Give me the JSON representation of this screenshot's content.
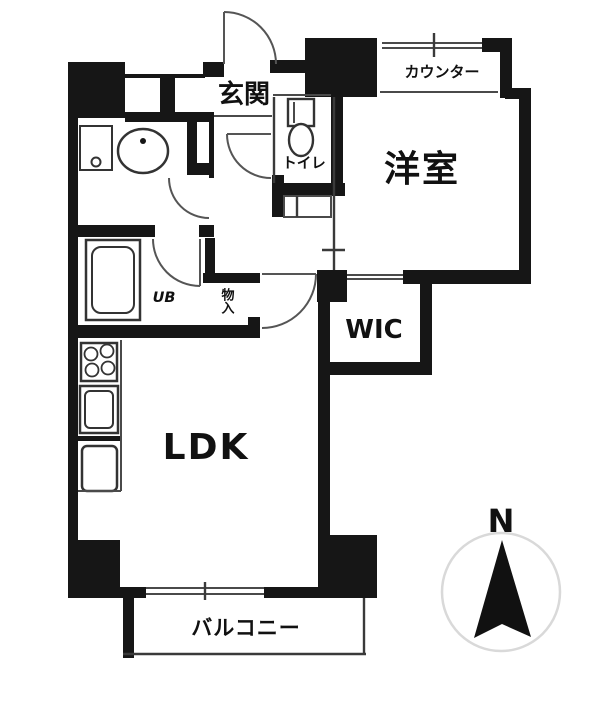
{
  "floorplan": {
    "rooms": {
      "genkan": {
        "label": "玄関"
      },
      "toilet": {
        "label": "トイレ"
      },
      "counter": {
        "label": "カウンター"
      },
      "western_room": {
        "label": "洋室"
      },
      "unit_bath": {
        "label": "UB"
      },
      "storage": {
        "label": "物入"
      },
      "wic": {
        "label": "WIC"
      },
      "ldk": {
        "label": "LDK"
      },
      "balcony": {
        "label": "バルコニー"
      }
    },
    "compass": {
      "north_label": "N"
    },
    "colors": {
      "wall": "#161616",
      "thin_line": "#3a3a3a",
      "door_arc": "#555555",
      "background": "#ffffff",
      "compass_circle": "#d9d9d9"
    }
  }
}
